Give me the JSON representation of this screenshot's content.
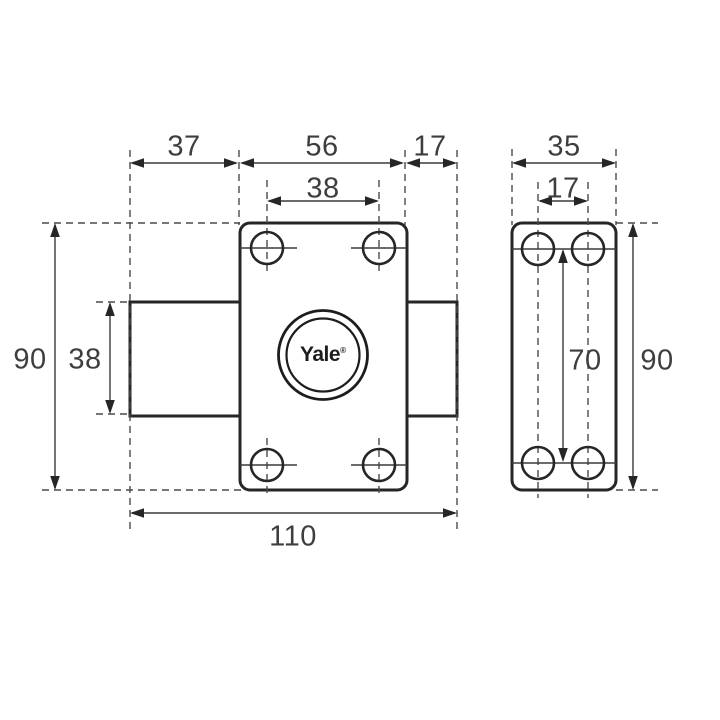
{
  "title": "Yale lock cylinder technical dimension drawing",
  "brand": {
    "logo_text": "Yale",
    "registered_mark": "®"
  },
  "colors": {
    "background": "#ffffff",
    "outline": "#262626",
    "thin_line": "#3a3a3a",
    "dashed_line": "#4a4a4a",
    "dimension_text": "#3e3e3e"
  },
  "views": {
    "front": {
      "name": "front view",
      "dimensions": {
        "offset_left": "37",
        "body_width": "56",
        "bolt_depth": "17",
        "hole_spacing_width": "38",
        "height": "90",
        "cylinder_height": "38",
        "total_width": "110"
      }
    },
    "side": {
      "name": "side view",
      "dimensions": {
        "width": "35",
        "hole_spacing_width": "17",
        "hole_spacing_height": "70",
        "height": "90"
      }
    }
  }
}
